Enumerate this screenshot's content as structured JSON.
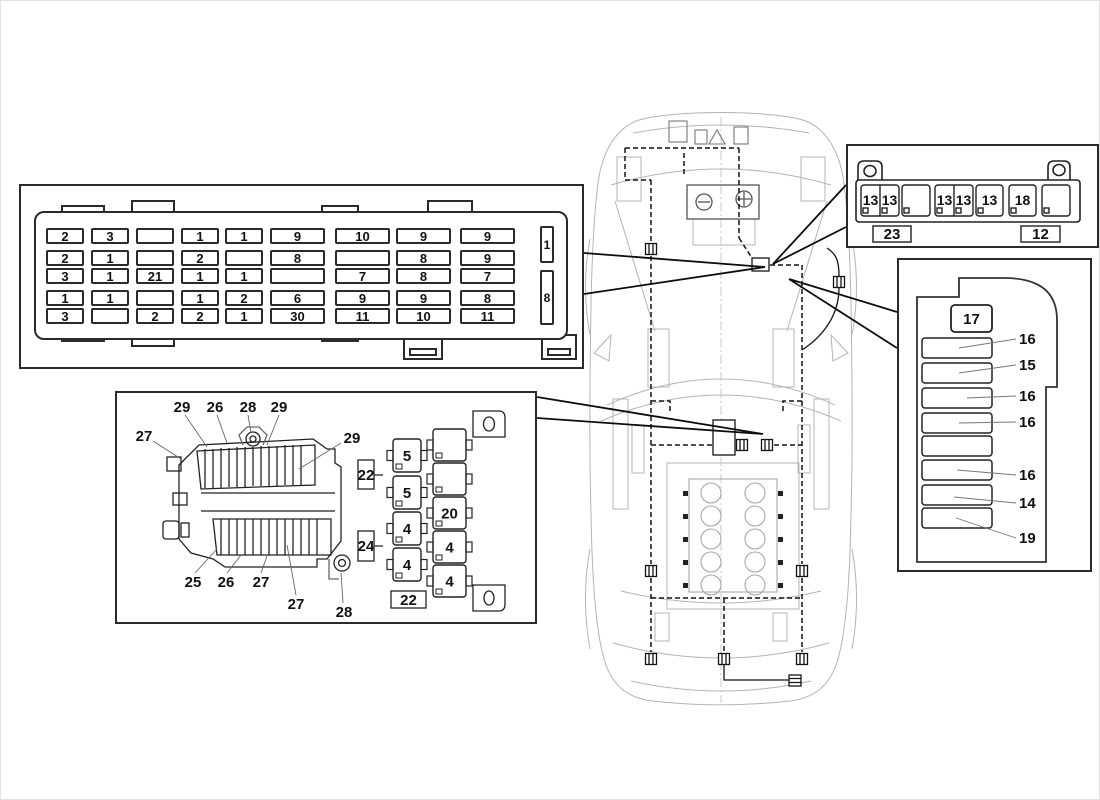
{
  "colors": {
    "line": "#1a1a1a",
    "light_outline": "#b4b4b4",
    "background": "#ffffff"
  },
  "main_fuse_box": {
    "rows": [
      [
        "2",
        "3",
        "",
        "1",
        "1",
        "9",
        "10",
        "9",
        "9"
      ],
      [
        "2",
        "1",
        "",
        "2",
        "",
        "8",
        "",
        "8",
        "9"
      ],
      [
        "3",
        "1",
        "21",
        "1",
        "1",
        "",
        "7",
        "8",
        "7"
      ],
      [
        "1",
        "1",
        "",
        "1",
        "2",
        "6",
        "9",
        "9",
        "8"
      ],
      [
        "3",
        "",
        "2",
        "2",
        "1",
        "30",
        "11",
        "10",
        "11"
      ]
    ],
    "side_labels": [
      "1",
      "8"
    ]
  },
  "relay_panel": {
    "top_labels": [
      "27",
      "29",
      "26",
      "28",
      "29",
      "29"
    ],
    "bottom_labels": [
      "25",
      "26",
      "27",
      "27",
      "28"
    ],
    "relay_left": [
      "5",
      "5",
      "4",
      "4"
    ],
    "relay_right": [
      "",
      "",
      "20",
      "4",
      "4"
    ],
    "connector_left": [
      "22",
      "24"
    ],
    "connector_bottom": "22"
  },
  "rear_connector_strip": {
    "cell_labels": [
      "13",
      "13",
      "13",
      "13",
      "13",
      "18"
    ],
    "bottom_labels": [
      "23",
      "12"
    ]
  },
  "interior_fuse_panel": {
    "top_label": "17",
    "slot_labels": [
      "16",
      "15",
      "16",
      "16",
      "",
      "16",
      "14",
      "19"
    ]
  }
}
